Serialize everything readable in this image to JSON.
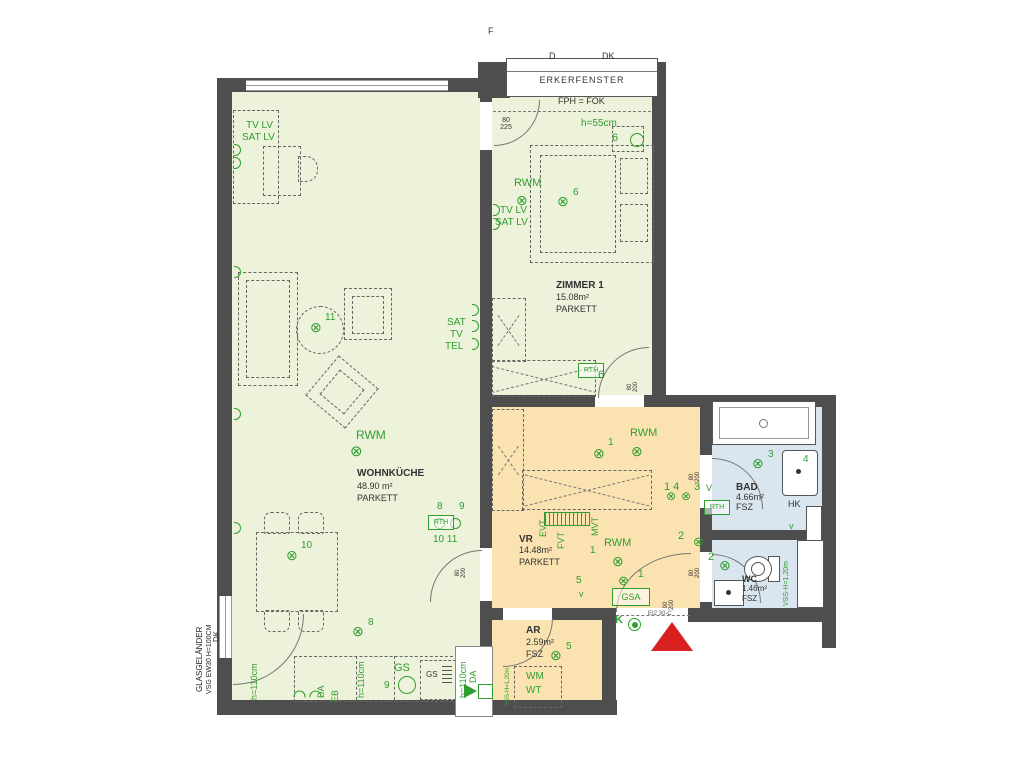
{
  "palette": {
    "room_green": "#edf2da",
    "room_orange": "#fbe3b1",
    "room_blue": "#d9e6ef",
    "wall": "#4e4e4e",
    "annotation_green": "#2f9e2f",
    "entrance_red": "#d92020"
  },
  "header": {
    "f_mark": "F",
    "d_mark": "D",
    "dk_mark": "DK",
    "erkerfenster": "ERKERFENSTER",
    "fph_fok": "FPH = FOK"
  },
  "rooms": {
    "wohnkueche": {
      "name": "WOHNKÜCHE",
      "area": "48.90 m²",
      "floor": "PARKETT"
    },
    "zimmer1": {
      "name": "ZIMMER 1",
      "area": "15.08m²",
      "floor": "PARKETT"
    },
    "vr": {
      "name": "VR",
      "area": "14.48m²",
      "floor": "PARKETT"
    },
    "bad": {
      "name": "BAD",
      "area": "4.66m²",
      "floor": "FSZ"
    },
    "wc": {
      "name": "WC",
      "area": "1.46m²",
      "floor": "FSZ"
    },
    "ar": {
      "name": "AR",
      "area": "2.59m²",
      "floor": "FSZ"
    }
  },
  "annotations": {
    "rwm": "RWM",
    "tv_lv": "TV LV",
    "sat_lv": "SAT LV",
    "sat": "SAT",
    "tv": "TV",
    "tel": "TEL",
    "rth": "RTH",
    "gsa": "GSA",
    "gs": "GS",
    "k": "K",
    "hk": "HK",
    "wm": "WM",
    "wt": "WT",
    "evt": "EVT",
    "fvt": "FVT",
    "mvt": "MVT",
    "da": "DA",
    "eb": "EB",
    "dk_vert": "DK",
    "h55": "h=55cm",
    "h110": "h=110cm",
    "vss": "VSS-H=1,20m",
    "glasgelaender": "GLASGELÄNDER",
    "vsg": "VSG EW30 H=100CM",
    "ei230": "EI2 30-C",
    "lamp": "⊗",
    "v_up": "V",
    "v_low": "v"
  },
  "numbers": {
    "n1": "1",
    "n2": "2",
    "n3": "3",
    "n4": "4",
    "n5": "5",
    "n6": "6",
    "n8": "8",
    "n9": "9",
    "n10": "10",
    "n11": "11",
    "n14": "1 4",
    "n10_11": "10 11"
  },
  "dims": {
    "d80_225": "80\n225",
    "d80_200": "80\n200",
    "d90_200": "90\n200"
  }
}
